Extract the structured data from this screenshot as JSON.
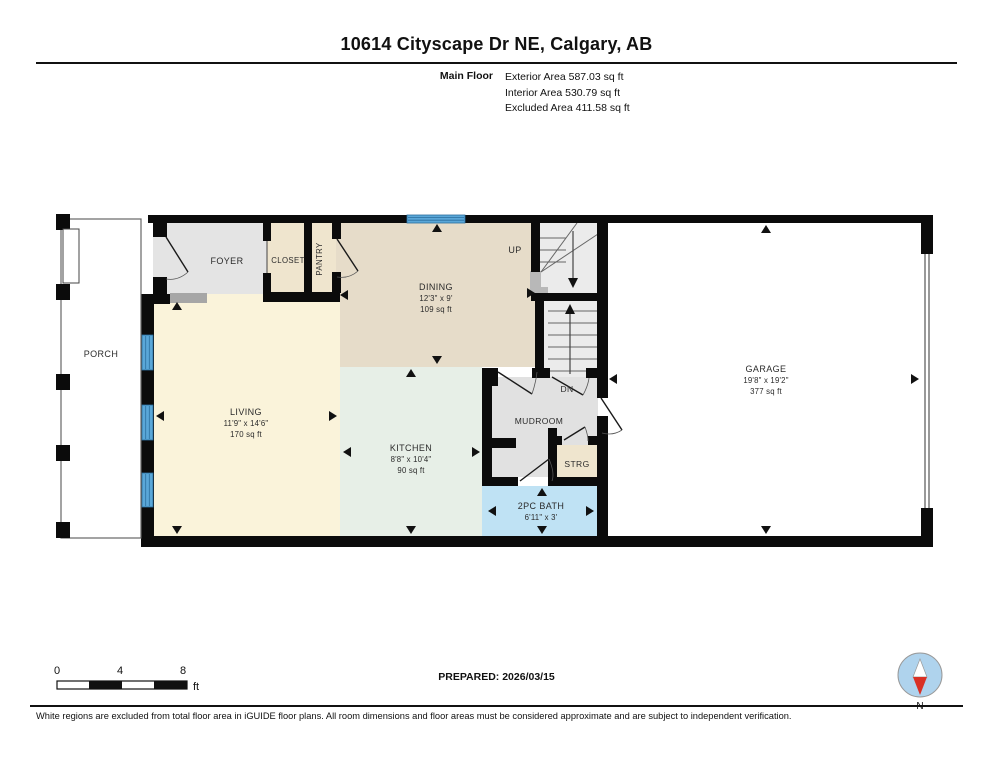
{
  "header": {
    "title": "10614 Cityscape Dr NE, Calgary, AB",
    "floor_label": "Main Floor",
    "areas": {
      "exterior": "Exterior Area 587.03 sq ft",
      "interior": "Interior Area 530.79 sq ft",
      "excluded": "Excluded Area 411.58 sq ft"
    }
  },
  "rooms": {
    "porch": {
      "name": "PORCH"
    },
    "foyer": {
      "name": "FOYER"
    },
    "closet": {
      "name": "CLOSET"
    },
    "pantry": {
      "name": "PANTRY"
    },
    "dining": {
      "name": "DINING",
      "dims": "12'3\" x 9'",
      "area": "109 sq ft"
    },
    "living": {
      "name": "LIVING",
      "dims": "11'9\" x 14'6\"",
      "area": "170 sq ft"
    },
    "kitchen": {
      "name": "KITCHEN",
      "dims": "8'8\" x 10'4\"",
      "area": "90 sq ft"
    },
    "mudroom": {
      "name": "MUDROOM"
    },
    "storage": {
      "name": "STRG"
    },
    "bath": {
      "name": "2PC BATH",
      "dims": "6'11\" x 3'"
    },
    "garage": {
      "name": "GARAGE",
      "dims": "19'8\" x 19'2\"",
      "area": "377 sq ft"
    },
    "stairs_up": "UP",
    "stairs_dn": "DN"
  },
  "scale_bar": {
    "t0": "0",
    "t4": "4",
    "t8": "8",
    "unit": "ft"
  },
  "footer": {
    "prepared": "PREPARED: 2026/03/15",
    "disclaimer": "White regions are excluded from total floor area in iGUIDE floor plans. All room dimensions and floor areas must be considered approximate and are subject to independent verification.",
    "compass_label": "N"
  },
  "colors": {
    "wall": "#0b0b0b",
    "living_floor": "#FAF3DA",
    "dining_floor": "#E6DCC9",
    "kitchen_floor": "#E7EFE7",
    "closet_floor": "#EFE5CE",
    "foyer_floor": "#E4E4E4",
    "bath_floor": "#BFE2F4",
    "window_blue": "#5AA7D8",
    "compass_red": "#D93025",
    "compass_circle": "#AFD3ED"
  }
}
